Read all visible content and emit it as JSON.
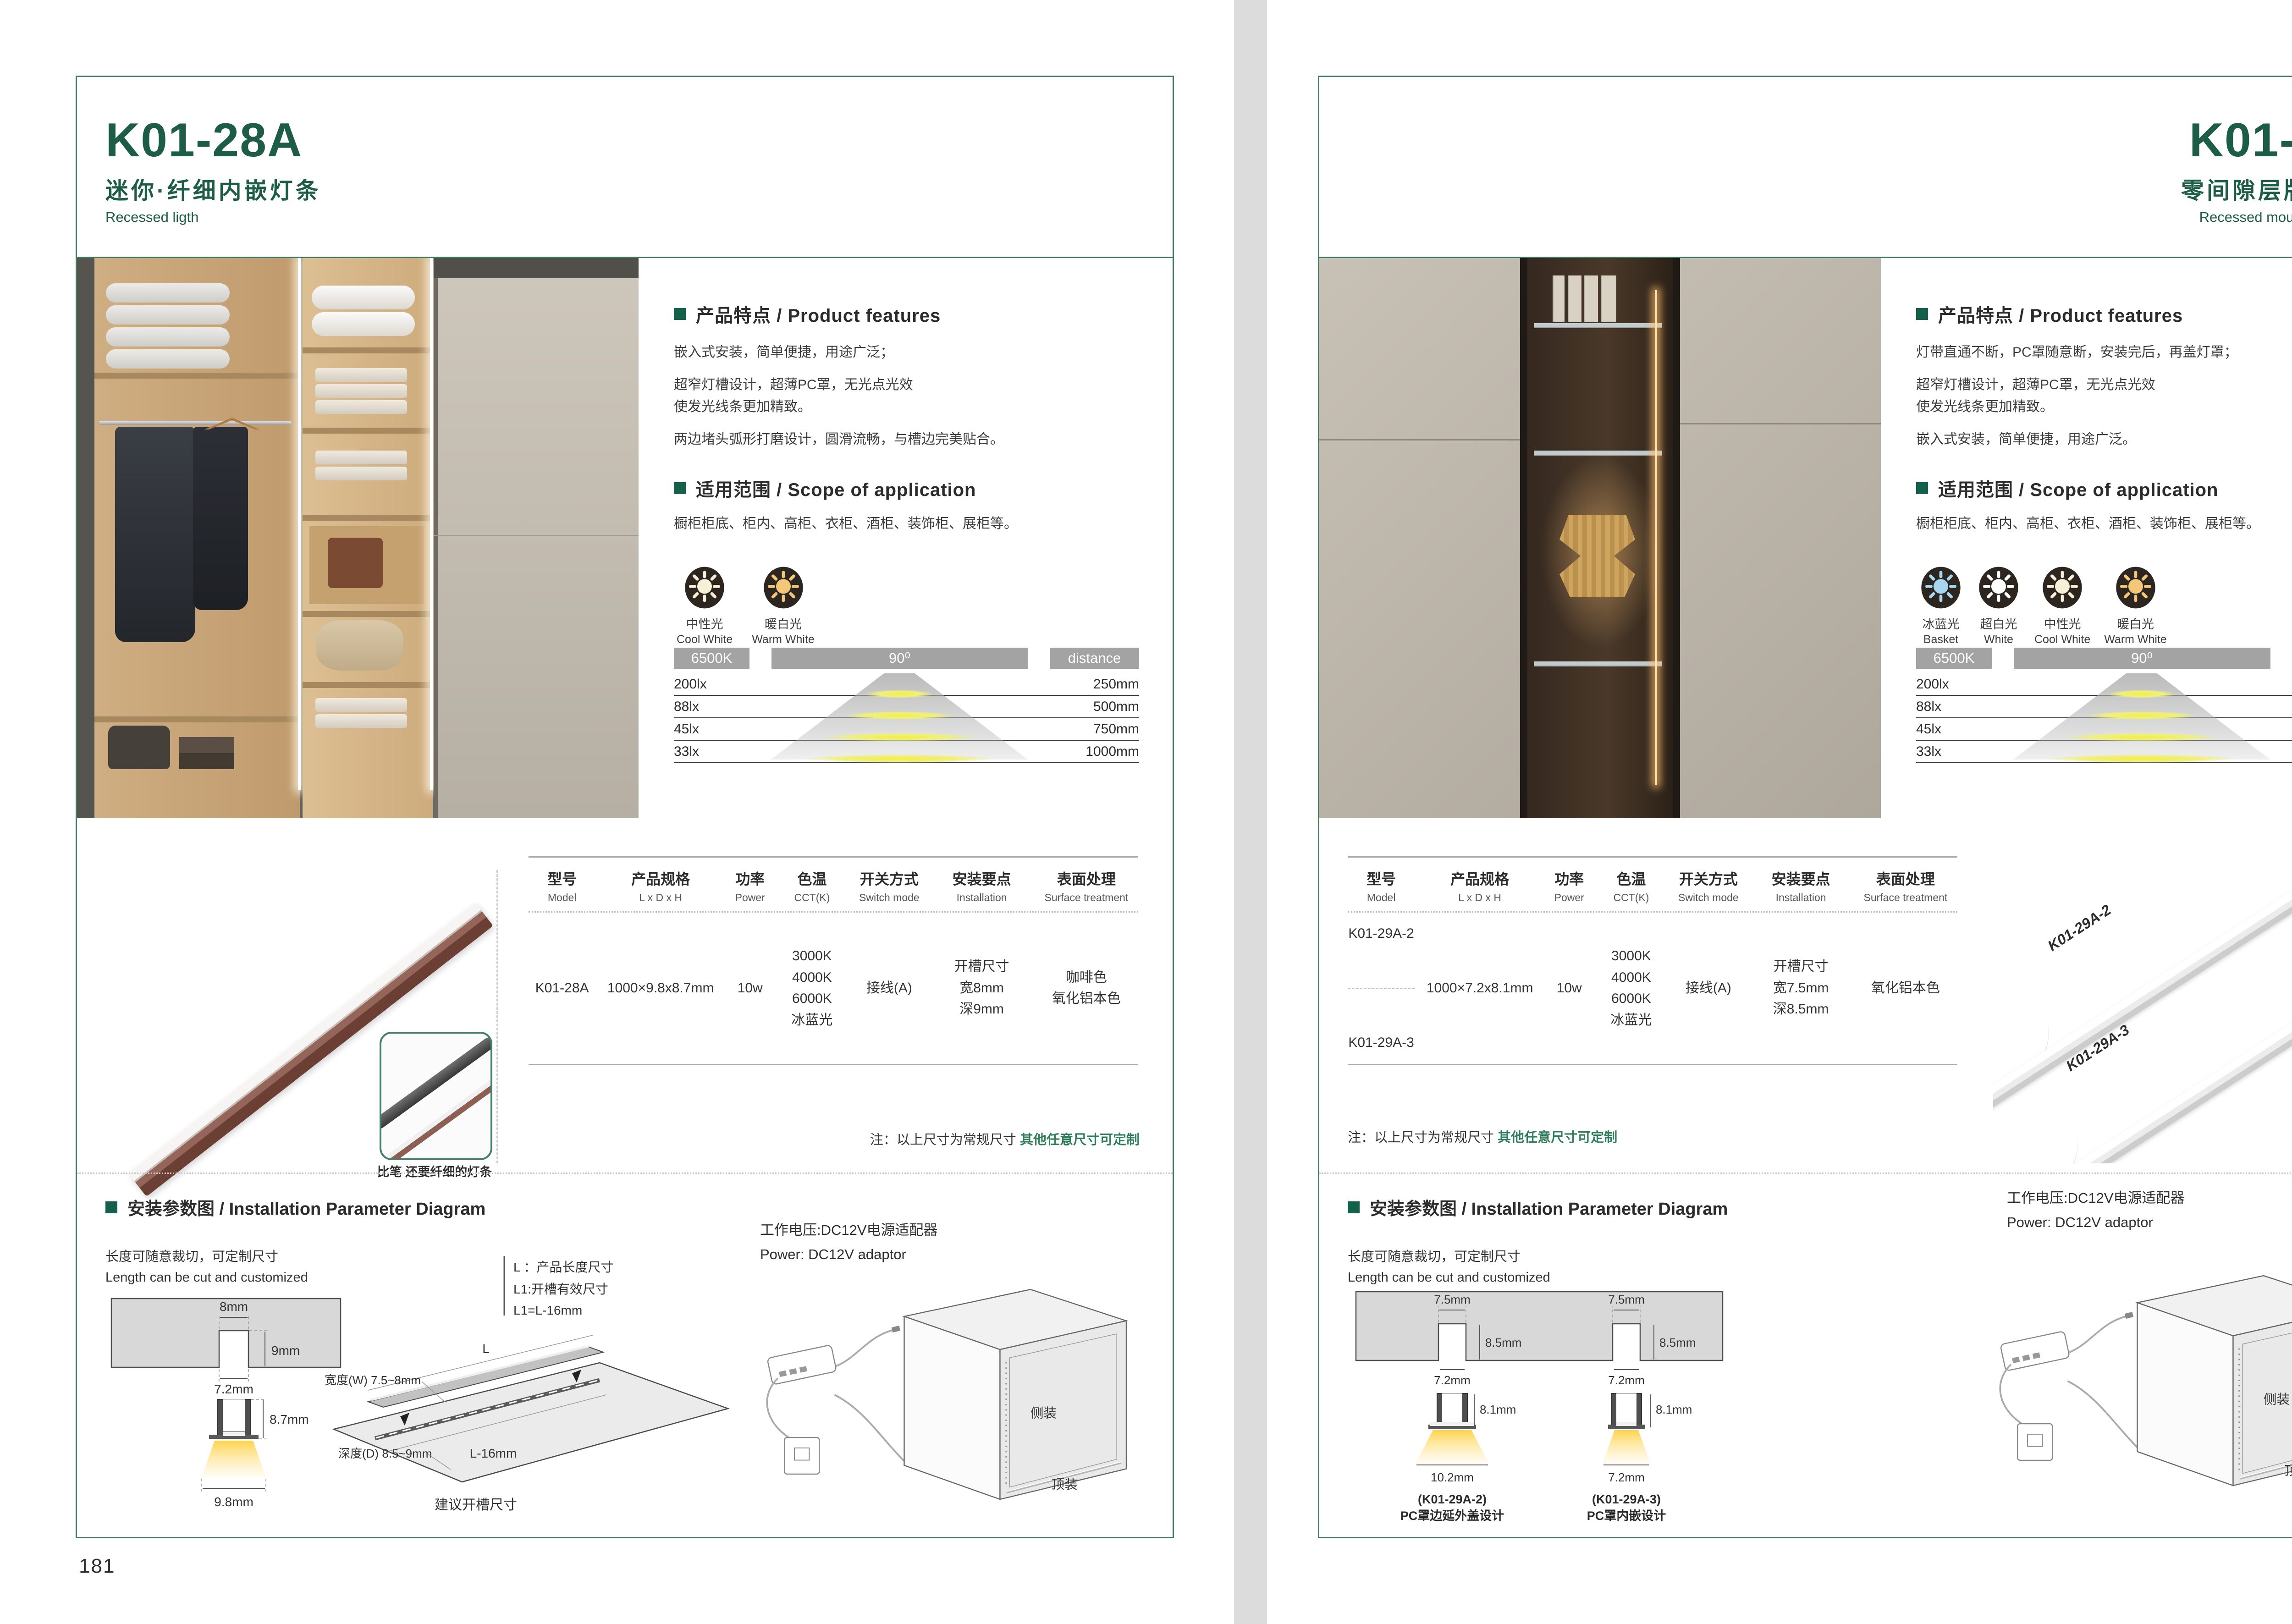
{
  "colors": {
    "brand_green": "#1d5c46",
    "border_green": "#45785f",
    "note_green": "#2e7d5b",
    "bar_gray": "#a3a3a3"
  },
  "pages": [
    {
      "page_number": "181",
      "header": {
        "model": "K01-28A",
        "subtitle_cn": "迷你·纤细内嵌灯条",
        "subtitle_en": "Recessed ligth"
      },
      "features": {
        "title": "产品特点 / Product features",
        "lines": [
          "嵌入式安装，简单便捷，用途广泛；",
          "超窄灯槽设计，超薄PC罩，无光点光效",
          "使发光线条更加精致。",
          "两边堵头弧形打磨设计，圆滑流畅，与槽边完美贴合。"
        ]
      },
      "scope": {
        "title": "适用范围 / Scope of application",
        "text": "橱柜柜底、柜内、高柜、衣柜、酒柜、装饰柜、展柜等。"
      },
      "light_icons": [
        {
          "cn": "中性光",
          "en": "Cool White",
          "color": "#f7efd6"
        },
        {
          "cn": "暖白光",
          "en": "Warm White",
          "color": "#f2c878"
        }
      ],
      "photometric": {
        "cct": "6500K",
        "angle": "90⁰",
        "distance": "distance",
        "rows": [
          {
            "lux": "200lx",
            "dist": "250mm"
          },
          {
            "lux": "88lx",
            "dist": "500mm"
          },
          {
            "lux": "45lx",
            "dist": "750mm"
          },
          {
            "lux": "33lx",
            "dist": "1000mm"
          }
        ]
      },
      "spec": {
        "headers": [
          {
            "cn": "型号",
            "en": "Model"
          },
          {
            "cn": "产品规格",
            "en": "L x D x H"
          },
          {
            "cn": "功率",
            "en": "Power"
          },
          {
            "cn": "色温",
            "en": "CCT(K)"
          },
          {
            "cn": "开关方式",
            "en": "Switch mode"
          },
          {
            "cn": "安装要点",
            "en": "Installation"
          },
          {
            "cn": "表面处理",
            "en": "Surface treatment"
          }
        ],
        "model": "K01-28A",
        "size": "1000×9.8x8.7mm",
        "power": "10w",
        "cct": [
          "3000K",
          "4000K",
          "6000K",
          "冰蓝光"
        ],
        "switch": "接线(A)",
        "install": [
          "开槽尺寸",
          "宽8mm",
          "深9mm"
        ],
        "surface": [
          "咖啡色",
          "氧化铝本色"
        ]
      },
      "note": {
        "prefix": "注：以上尺寸为常规尺寸 ",
        "highlight": "其他任意尺寸可定制"
      },
      "product_caption": "比笔 还要纤细的灯条",
      "install_section": {
        "title": "安装参数图 / Installation Parameter Diagram",
        "cut_cn": "长度可随意裁切，可定制尺寸",
        "cut_en": "Length can be cut and customized",
        "cross": {
          "top": "8mm",
          "depth": "9mm",
          "slot": "7.2mm",
          "height": "8.7mm",
          "beam": "9.8mm"
        },
        "legend": [
          "L ：产品长度尺寸",
          "L1:开槽有效尺寸",
          "L1=L-16mm"
        ],
        "board": {
          "len": "L",
          "groove": "L-16mm",
          "width": "宽度(W) 7.5~8mm",
          "depth": "深度(D) 8.5~9mm",
          "caption": "建议开槽尺寸"
        },
        "power_cn": "工作电压:DC12V电源适配器",
        "power_en": "Power: DC12V adaptor",
        "cabinet": {
          "side": "侧装",
          "top": "顶装"
        }
      }
    },
    {
      "page_number": "182",
      "header": {
        "model": "K01-29A",
        "subtitle_cn": "零间隙层版条形灯",
        "subtitle_en": "Recessed mounting LED light"
      },
      "features": {
        "title": "产品特点 / Product features",
        "lines": [
          "灯带直通不断，PC罩随意断，安装完后，再盖灯罩；",
          "超窄灯槽设计，超薄PC罩，无光点光效",
          "使发光线条更加精致。",
          "嵌入式安装，简单便捷，用途广泛。"
        ]
      },
      "scope": {
        "title": "适用范围 / Scope of application",
        "text": "橱柜柜底、柜内、高柜、衣柜、酒柜、装饰柜、展柜等。"
      },
      "light_icons": [
        {
          "cn": "冰蓝光",
          "en": "Basket",
          "color": "#a6d7ef"
        },
        {
          "cn": "超白光",
          "en": "White",
          "color": "#ffffff"
        },
        {
          "cn": "中性光",
          "en": "Cool White",
          "color": "#f7efd6"
        },
        {
          "cn": "暖白光",
          "en": "Warm White",
          "color": "#f2c878"
        }
      ],
      "photometric": {
        "cct": "6500K",
        "angle": "90⁰",
        "distance": "distance",
        "rows": [
          {
            "lux": "200lx",
            "dist": "250mm"
          },
          {
            "lux": "88lx",
            "dist": "500mm"
          },
          {
            "lux": "45lx",
            "dist": "750mm"
          },
          {
            "lux": "33lx",
            "dist": "1000mm"
          }
        ]
      },
      "spec": {
        "headers": [
          {
            "cn": "型号",
            "en": "Model"
          },
          {
            "cn": "产品规格",
            "en": "L x D x H"
          },
          {
            "cn": "功率",
            "en": "Power"
          },
          {
            "cn": "色温",
            "en": "CCT(K)"
          },
          {
            "cn": "开关方式",
            "en": "Switch mode"
          },
          {
            "cn": "安装要点",
            "en": "Installation"
          },
          {
            "cn": "表面处理",
            "en": "Surface treatment"
          }
        ],
        "models": [
          "K01-29A-2",
          "K01-29A-3"
        ],
        "size": "1000×7.2x8.1mm",
        "power": "10w",
        "cct": [
          "3000K",
          "4000K",
          "6000K",
          "冰蓝光"
        ],
        "switch": "接线(A)",
        "install": [
          "开槽尺寸",
          "宽7.5mm",
          "深8.5mm"
        ],
        "surface": [
          "氧化铝本色"
        ]
      },
      "note": {
        "prefix": "注：以上尺寸为常规尺寸 ",
        "highlight": "其他任意尺寸可定制"
      },
      "strip_labels": [
        "K01-29A-2",
        "K01-29A-3"
      ],
      "install_section": {
        "title": "安装参数图 / Installation Parameter Diagram",
        "cut_cn": "长度可随意裁切，可定制尺寸",
        "cut_en": "Length can be cut and customized",
        "cross_sections": [
          {
            "top": "7.5mm",
            "depth": "8.5mm",
            "slot": "7.2mm",
            "height": "8.1mm",
            "beam": "10.2mm",
            "model": "(K01-29A-2)",
            "desc": "PC罩边延外盖设计"
          },
          {
            "top": "7.5mm",
            "depth": "8.5mm",
            "slot": "7.2mm",
            "height": "8.1mm",
            "beam": "7.2mm",
            "model": "(K01-29A-3)",
            "desc": "PC罩内嵌设计"
          }
        ],
        "power_cn": "工作电压:DC12V电源适配器",
        "power_en": "Power: DC12V adaptor",
        "cabinet": {
          "side": "侧装",
          "top": "顶装"
        }
      }
    }
  ]
}
